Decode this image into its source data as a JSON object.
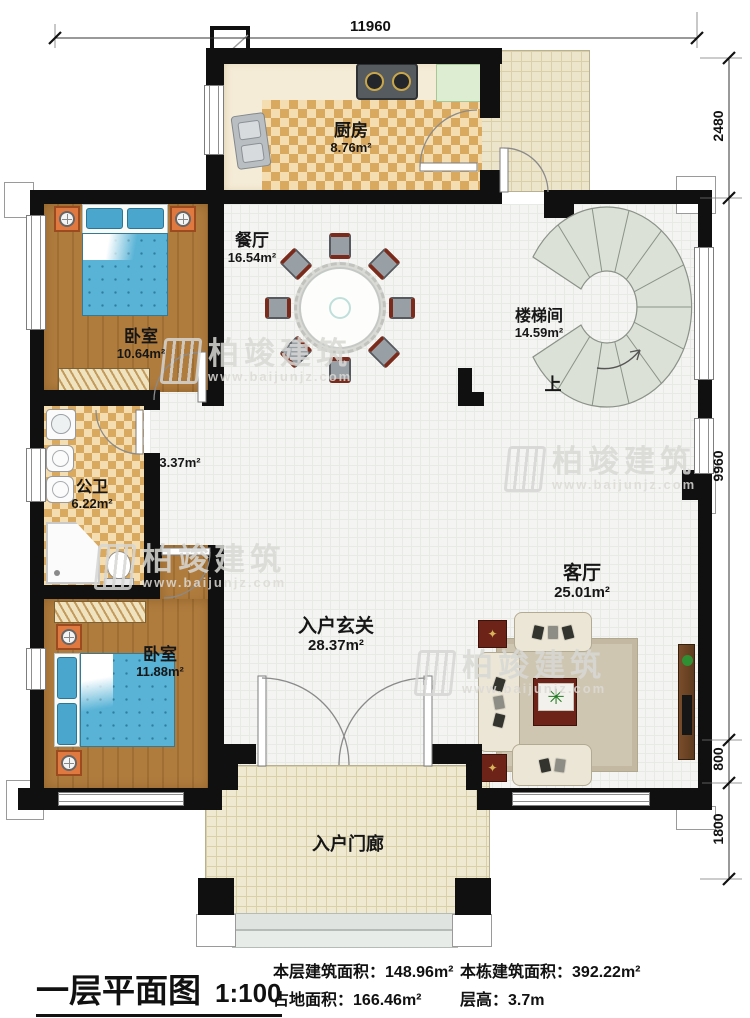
{
  "title": {
    "text": "一层平面图",
    "scale": "1:100"
  },
  "stats": [
    {
      "label": "本层建筑面积：",
      "value": "148.96m²"
    },
    {
      "label": "占地面积：",
      "value": "166.46m²"
    },
    {
      "label": "本栋建筑面积：",
      "value": "392.22m²"
    },
    {
      "label": "层高：",
      "value": "3.7m"
    }
  ],
  "dimensions": {
    "top": "11960",
    "right": [
      "2480",
      "9960",
      "800",
      "1800"
    ]
  },
  "rooms": {
    "kitchen": {
      "name": "厨房",
      "area": "8.76m²"
    },
    "dining": {
      "name": "餐厅",
      "area": "16.54m²"
    },
    "bedroom1": {
      "name": "卧室",
      "area": "10.64m²"
    },
    "stairwell": {
      "name": "楼梯间",
      "area": "14.59m²",
      "up": "上"
    },
    "bathroom": {
      "name": "公卫",
      "area": "6.22m²"
    },
    "hallway": {
      "area": "3.37m²"
    },
    "bedroom2": {
      "name": "卧室",
      "area": "11.88m²"
    },
    "foyer": {
      "name": "入户玄关",
      "area": "28.37m²"
    },
    "living": {
      "name": "客厅",
      "area": "25.01m²"
    },
    "porch": {
      "name": "入户门廊"
    }
  },
  "watermark": {
    "brand": "柏竣建筑",
    "url": "www.baijunjz.com"
  },
  "colors": {
    "wall": "#101010",
    "wood": "#ad7a3d",
    "tile": "#d8a95f",
    "bed": "#58b3d6",
    "accent_red": "#6e2318"
  }
}
